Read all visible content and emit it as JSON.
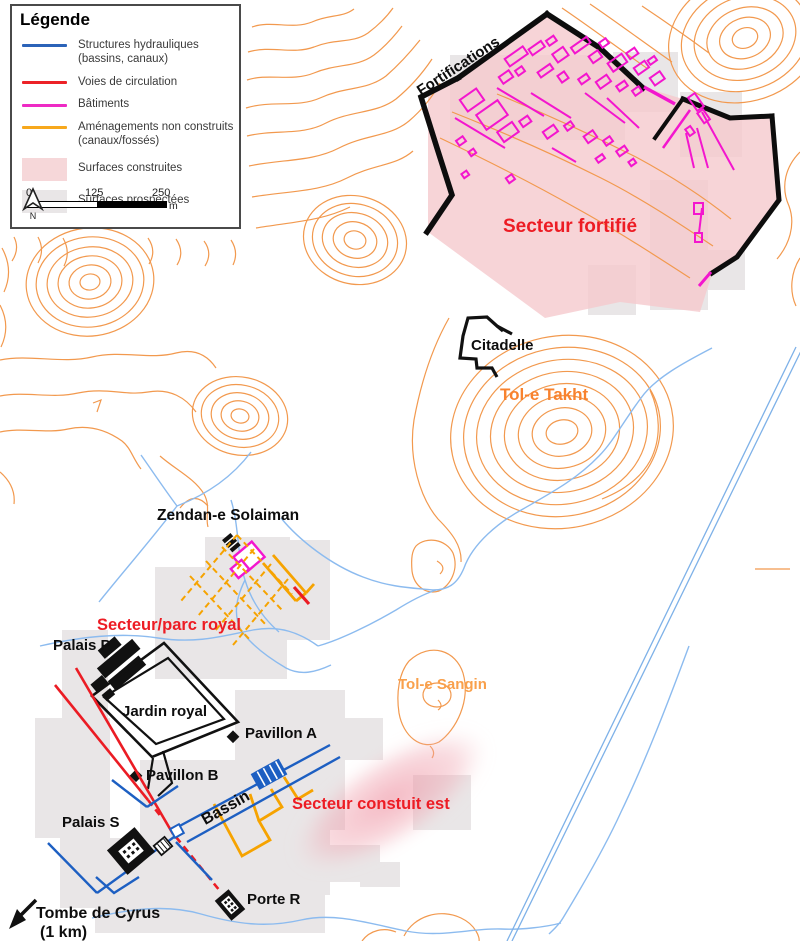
{
  "legend": {
    "title": "Légende",
    "items": [
      {
        "label": "Structures hydrauliques",
        "label2": "(bassins, canaux)",
        "color": "#2b63b8",
        "type": "line"
      },
      {
        "label": "Voies de circulation",
        "color": "#ec2227",
        "type": "line"
      },
      {
        "label": "Bâtiments",
        "color": "#ee2ac4",
        "type": "line"
      },
      {
        "label": "Aménagements non construits",
        "label2": "(canaux/fossés)",
        "color": "#f7a81c",
        "type": "line"
      },
      {
        "label": "Surfaces construites",
        "color": "#f6d7d9",
        "type": "fill"
      },
      {
        "label": "Surfaces prospectées",
        "color": "#e9e6e7",
        "type": "fill"
      }
    ],
    "scale": {
      "tick0": "0",
      "tick1": "125",
      "tick2": "250",
      "unit": "m",
      "north": "N"
    }
  },
  "map_labels": {
    "fortifications": "Fortifications",
    "secteur_fortifie": "Secteur fortifié",
    "citadelle": "Citadelle",
    "tol_e_takht": "Tol-e Takht",
    "zendan": "Zendan-e Solaiman",
    "secteur_parc_royal": "Secteur/parc royal",
    "palais_p": "Palais P",
    "jardin_royal": "Jardin royal",
    "pavillon_a": "Pavillon A",
    "pavillon_b": "Pavillon B",
    "bassin": "Bassin",
    "tol_e_sangin": "Tol-e Sangin",
    "secteur_construit_est": "Secteur constuit est",
    "palais_s": "Palais S",
    "porte_r": "Porte R",
    "tombe_de_cyrus_line1": "Tombe de Cyrus",
    "tombe_de_cyrus_line2": "(1 km)"
  },
  "icons": {
    "north_arrow": "north-arrow",
    "tombe_arrow": "southwest-arrow"
  },
  "colors": {
    "contours": "#f2994e",
    "streams": "#8cbbef",
    "hydraulic": "#1d5fc2",
    "roads": "#eb1c24",
    "buildings_magenta": "#f316ce",
    "non_built_orange": "#f6a300",
    "built_surface_pink": "#f5c9cd",
    "prospected_gray": "#e9e6e7",
    "label_red": "#ed1c24",
    "label_orange_takht": "#f8822e",
    "label_orange_sangin": "#f9a04b",
    "fortification_black": "#0d0d0d"
  }
}
